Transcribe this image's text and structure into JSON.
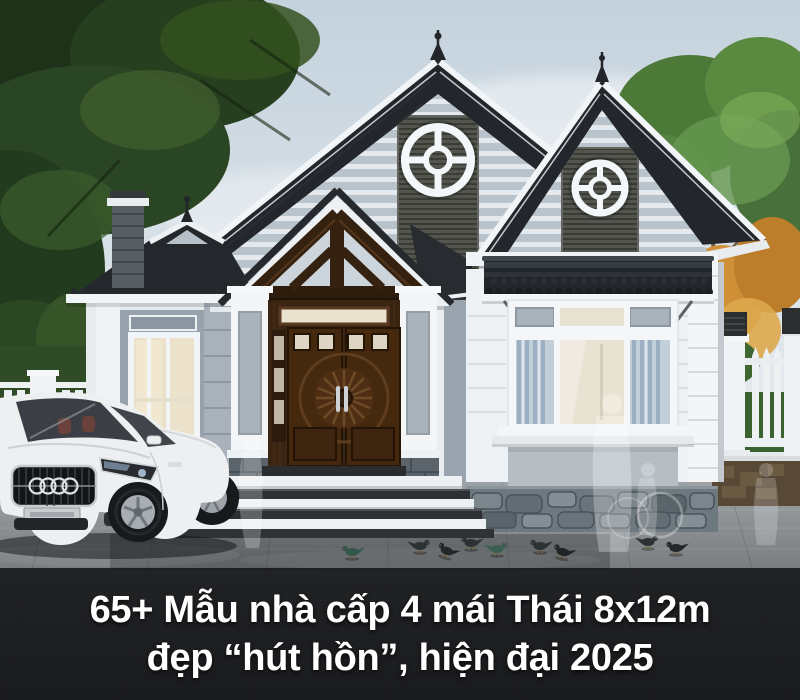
{
  "caption": {
    "line1": "65+ Mẫu nhà cấp 4 mái Thái 8x12m",
    "line2": "đẹp “hút hồn”, hiện đại 2025",
    "text_color": "#ffffff",
    "band_color": "rgba(19,20,22,0.86)"
  },
  "scene": {
    "sky": {
      "top": "#c4d2dd",
      "bottom": "#eef1f2"
    },
    "house": {
      "wall_white": "#eff2f4",
      "accent_wall_gray": "#99a4ae",
      "gable_siding": "#b9c3cc",
      "gable_slat_panel": "#53554e",
      "roof_dark": "#23262b",
      "trim_white": "#f2f5f7",
      "wood_truss": "#35210f",
      "front_door_wood": "#45290f",
      "stone_base": "#6e787f",
      "window_curtain_blue": "#9cb0c1",
      "interior_warm_light": "#ece2cb",
      "gable_vent_count": 2
    },
    "icons": {
      "gable_vent": "circular-wheel-vent",
      "car_brand": "four-overlapping-rings",
      "roof_finial": "spire"
    },
    "objects": {
      "car": {
        "type": "white coupe",
        "body_color": "#edeff1"
      },
      "fence": "white picket fence with lantern pillars",
      "pigeons": 9,
      "ghost_figures": 4,
      "trees": [
        "dark green canopy left",
        "green + autumn orange right"
      ],
      "driveway": "#9aa0a5"
    }
  }
}
